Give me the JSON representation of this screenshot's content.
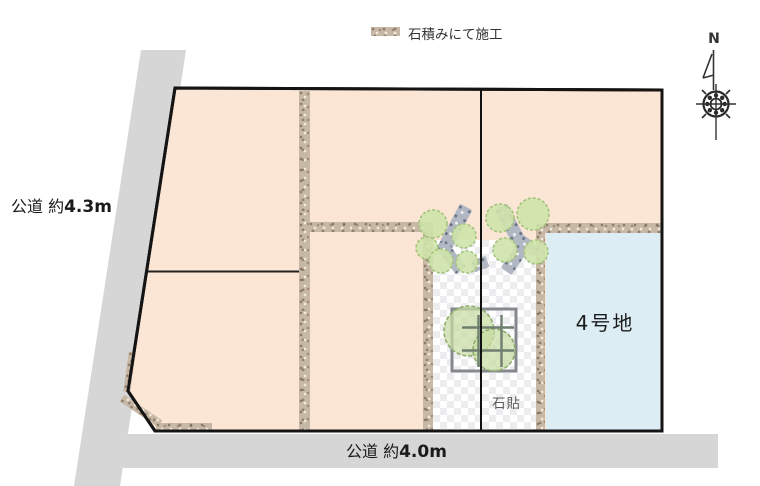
{
  "legend": {
    "label": "石積みにて施工",
    "swatch_texture": "stone-masonry"
  },
  "compass": {
    "north_label": "N"
  },
  "roads": {
    "left": {
      "prefix": "公道 約",
      "value": "4.3m"
    },
    "bottom": {
      "prefix": "公道 約",
      "value": "4.0m"
    }
  },
  "site": {
    "lot4_label": "4号地",
    "stone_paving_label": "石貼"
  },
  "colors": {
    "plot_peach": "#fbe5d5",
    "lot4_blue": "#ddedf4",
    "road_gray": "#d6d6d6",
    "stone_tan": "#c7b7a5",
    "rock_gray": "#b2b8c3",
    "tree_green": "#cfe3ab",
    "boundary_black": "#141414"
  }
}
